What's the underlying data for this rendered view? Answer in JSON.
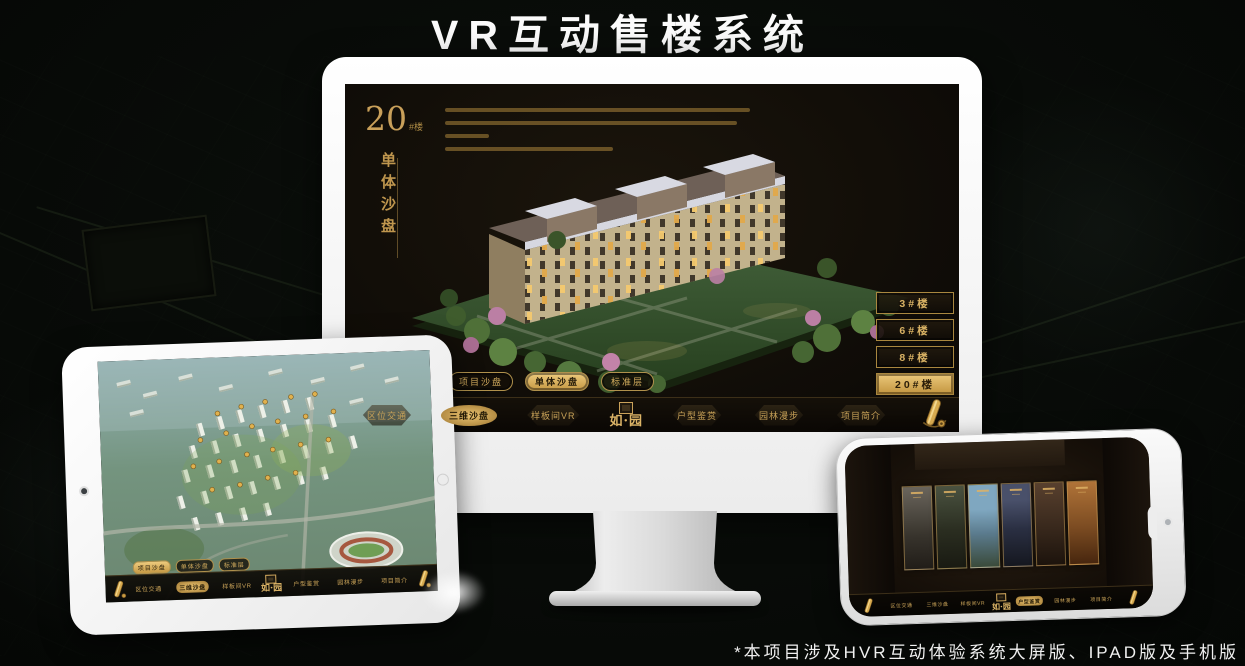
{
  "colors": {
    "gold": "#c9a05a",
    "gold_bright": "#e3bb6a",
    "screen_bg": "#14100a",
    "white_bezel": "#f5f5f5"
  },
  "poster": {
    "title": "VR互动售楼系统",
    "footnote": "*本项目涉及HVR互动体验系统大屏版、IPAD版及手机版"
  },
  "desktop": {
    "floor_number": "20",
    "floor_suffix": "#楼",
    "section_title_vertical": "单体沙盘",
    "floor_buttons": [
      {
        "label": "3#楼",
        "active": false
      },
      {
        "label": "6#楼",
        "active": false
      },
      {
        "label": "8#楼",
        "active": false
      },
      {
        "label": "20#楼",
        "active": true
      }
    ],
    "view_tabs": [
      {
        "label": "项目沙盘",
        "active": false
      },
      {
        "label": "单体沙盘",
        "active": true
      },
      {
        "label": "标准层",
        "active": false
      }
    ],
    "nav_items": [
      {
        "label": "区位交通",
        "active": false
      },
      {
        "label": "三维沙盘",
        "active": true
      },
      {
        "label": "样板间VR",
        "active": false
      },
      {
        "label": "户型鉴赏",
        "active": false
      },
      {
        "label": "园林漫步",
        "active": false
      },
      {
        "label": "项目简介",
        "active": false
      }
    ],
    "logo": "如·园"
  },
  "tablet": {
    "view_tabs": [
      {
        "label": "项目沙盘",
        "active": true
      },
      {
        "label": "单体沙盘",
        "active": false
      },
      {
        "label": "标准层",
        "active": false
      }
    ],
    "nav_items": [
      {
        "label": "区位交通",
        "active": false
      },
      {
        "label": "三维沙盘",
        "active": true
      },
      {
        "label": "样板间VR",
        "active": false
      },
      {
        "label": "户型鉴赏",
        "active": false
      },
      {
        "label": "园林漫步",
        "active": false
      },
      {
        "label": "项目简介",
        "active": false
      }
    ],
    "logo": "如·园"
  },
  "phone": {
    "nav_items": [
      {
        "label": "区位交通",
        "active": false
      },
      {
        "label": "三维沙盘",
        "active": false
      },
      {
        "label": "样板间VR",
        "active": false
      },
      {
        "label": "户型鉴赏",
        "active": true
      },
      {
        "label": "园林漫步",
        "active": false
      },
      {
        "label": "项目简介",
        "active": false
      }
    ],
    "logo": "如·园"
  }
}
